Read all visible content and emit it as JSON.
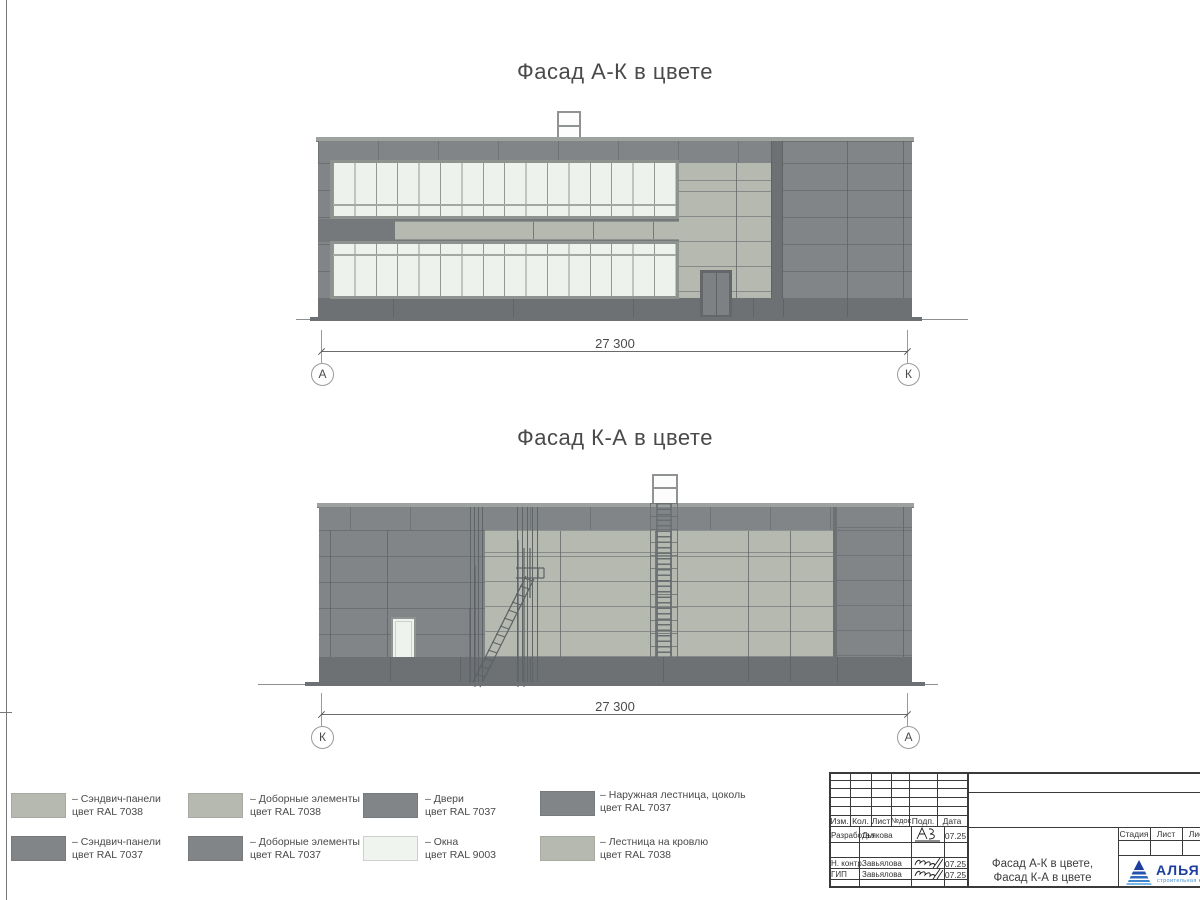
{
  "colors": {
    "ral7037": "#818587",
    "ral7038": "#b6b9af",
    "ral9003": "#f0f4ef",
    "plinth": "#6d7173",
    "logo_blue": "#1d3e9c"
  },
  "facade_ak": {
    "title": "Фасад А-К в цвете",
    "dim": "27 300",
    "axis_left": "А",
    "axis_right": "К"
  },
  "facade_ka": {
    "title": "Фасад К-А в цвете",
    "dim": "27 300",
    "axis_left": "К",
    "axis_right": "А"
  },
  "legend": {
    "items": [
      {
        "color": "#b6b9af",
        "line1": "– Сэндвич-панели",
        "line2": "цвет RAL 7038"
      },
      {
        "color": "#818587",
        "line1": "– Сэндвич-панели",
        "line2": "цвет RAL 7037"
      },
      {
        "color": "#b6b9af",
        "line1": "– Доборные элементы",
        "line2": "цвет RAL 7038"
      },
      {
        "color": "#818587",
        "line1": "– Доборные элементы",
        "line2": "цвет RAL 7037"
      },
      {
        "color": "#818587",
        "line1": "– Двери",
        "line2": "цвет RAL 7037"
      },
      {
        "color": "#f0f4ef",
        "line1": "– Окна",
        "line2": "цвет RAL 9003"
      },
      {
        "color": "#818587",
        "line1": "– Наружная лестница, цоколь",
        "line2": "цвет RAL 7037"
      },
      {
        "color": "#b6b9af",
        "line1": "– Лестница на кровлю",
        "line2": "цвет RAL 7038"
      }
    ]
  },
  "stamp": {
    "rev_cols": [
      "Изм.",
      "Кол.",
      "Лист",
      "№док",
      "Подп.",
      "Дата"
    ],
    "sign_rows": [
      {
        "role": "Разработал",
        "name": "Дьякова",
        "date": "07.25"
      },
      {
        "role": "Н. контр.",
        "name": "Завьялова",
        "date": "07.25"
      },
      {
        "role": "ГИП",
        "name": "Завьялова",
        "date": "07.25"
      }
    ],
    "doc_title": [
      "Фасад А-К в цвете,",
      "Фасад К-А в цвете"
    ],
    "stage_cols": [
      "Стадия",
      "Лист",
      "Лист"
    ],
    "logo": {
      "name": "АЛЬЯНС",
      "subtitle": "строительная компания"
    }
  }
}
